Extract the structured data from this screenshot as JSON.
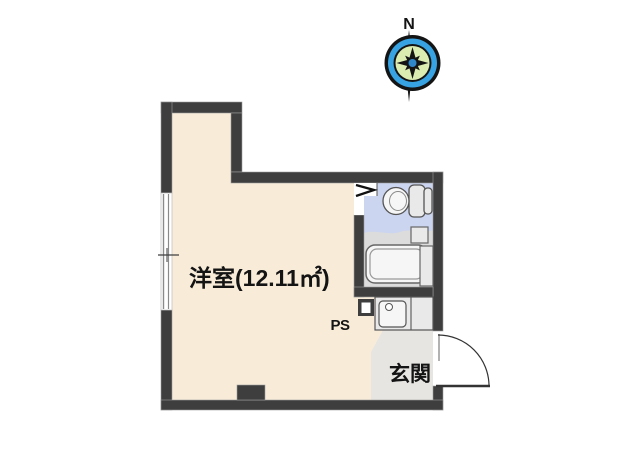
{
  "compass": {
    "north_label": "N"
  },
  "plan": {
    "room_label": "洋室(12.11㎡)",
    "room_area_sqm": "12.11",
    "ps_label": "PS",
    "entrance_label": "玄関"
  },
  "colors": {
    "wall": "#3e3e3e",
    "room_floor": "#f8ecd9",
    "toilet_floor": "#ccd5ef",
    "bath_floor": "#dcdcdc",
    "entrance_floor": "#e7e5e1",
    "fixture_fill": "#e9e9e9",
    "fixture_light": "#f6f6f6",
    "compass_blue": "#38a3e2",
    "compass_green": "#dcedb2",
    "compass_dark": "#141414",
    "compass_center": "#2f86c8"
  }
}
